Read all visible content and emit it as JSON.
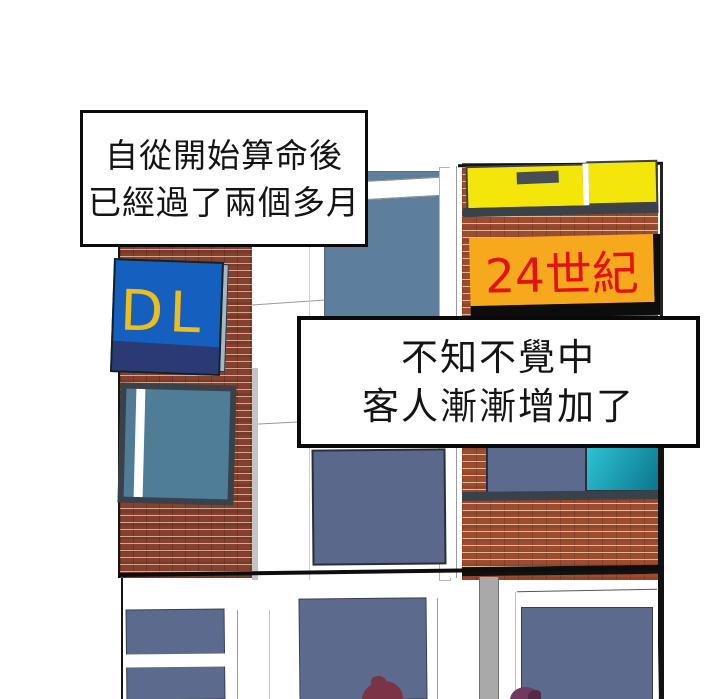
{
  "captions": {
    "box1": {
      "line1": "自從開始算命後",
      "line2": "已經過了兩個多月"
    },
    "box2": {
      "line1": "不知不覺中",
      "line2": "客人漸漸增加了"
    }
  },
  "signs": {
    "blue_sign_text": "DL",
    "orange_sign_text": "24世紀"
  },
  "colors": {
    "background": "#ffffff",
    "brick_left_wall": "#86402f",
    "brick_right_wall": "#9e4c30",
    "mortar": "#e1ba9c",
    "blue_sign_face": "#1560bf",
    "blue_sign_bottom_band": "#2c3a74",
    "blue_sign_letters": "#edbd1b",
    "yellow_window": "#f4e50a",
    "orange_sign": "#f6a91c",
    "orange_sign_text_red": "#e31111",
    "steel_blue_window": "#5d7f9d",
    "slate_window": "#5c6b8d",
    "teal_window_gradient_start": "#2ec3d2",
    "teal_window_gradient_end": "#0b758d",
    "left_window_glass": "#4f7d98",
    "dark_window_frame": "#39414a",
    "caption_border": "#0a0a0a",
    "pedestrian_head_left": "#7b3348",
    "pedestrian_head_right": "#6f3b60"
  }
}
